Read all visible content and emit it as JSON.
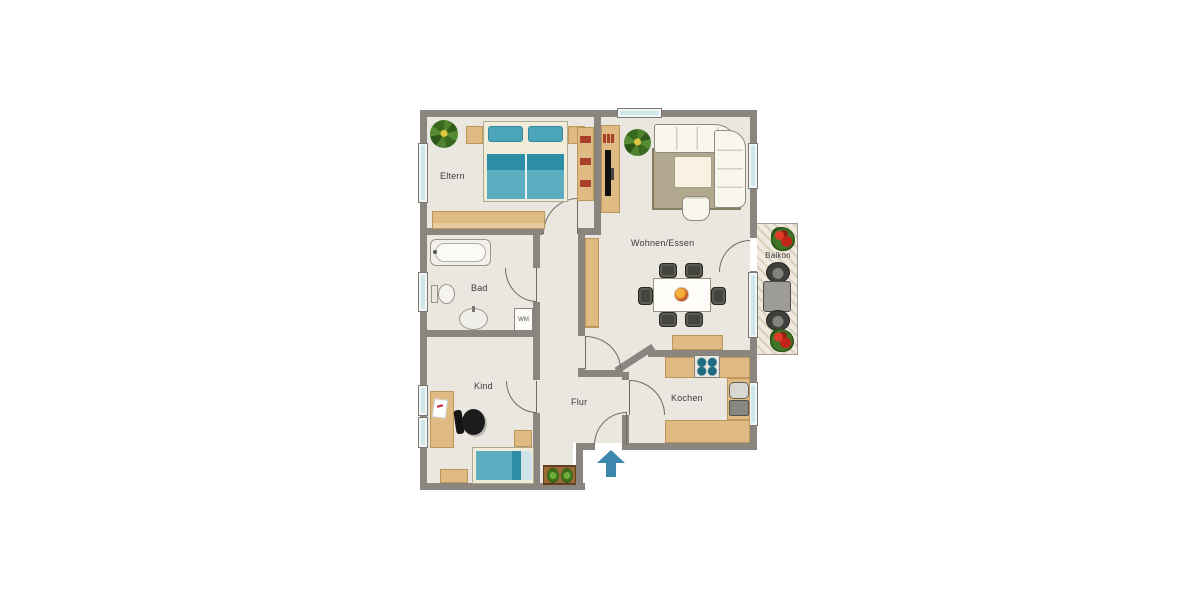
{
  "labels": {
    "eltern": "Eltern",
    "bad": "Bad",
    "kind": "Kind",
    "flur": "Flur",
    "wohnen_essen": "Wohnen/Essen",
    "kochen": "Kochen",
    "balkon": "Balkon",
    "wm": "WM"
  },
  "colors": {
    "wall": "#8b8580",
    "floor": "#eae7e1",
    "furniture_wood": "#dfba82",
    "bed_teal": "#5cadc0",
    "bed_teal_dark": "#2d8ca6",
    "window_glass": "#cfe7ea",
    "rug": "#b2a88f",
    "entrance_arrow": "#3d87ad",
    "flower_red": "#c22418",
    "plant_green": "#4a7d2a"
  }
}
